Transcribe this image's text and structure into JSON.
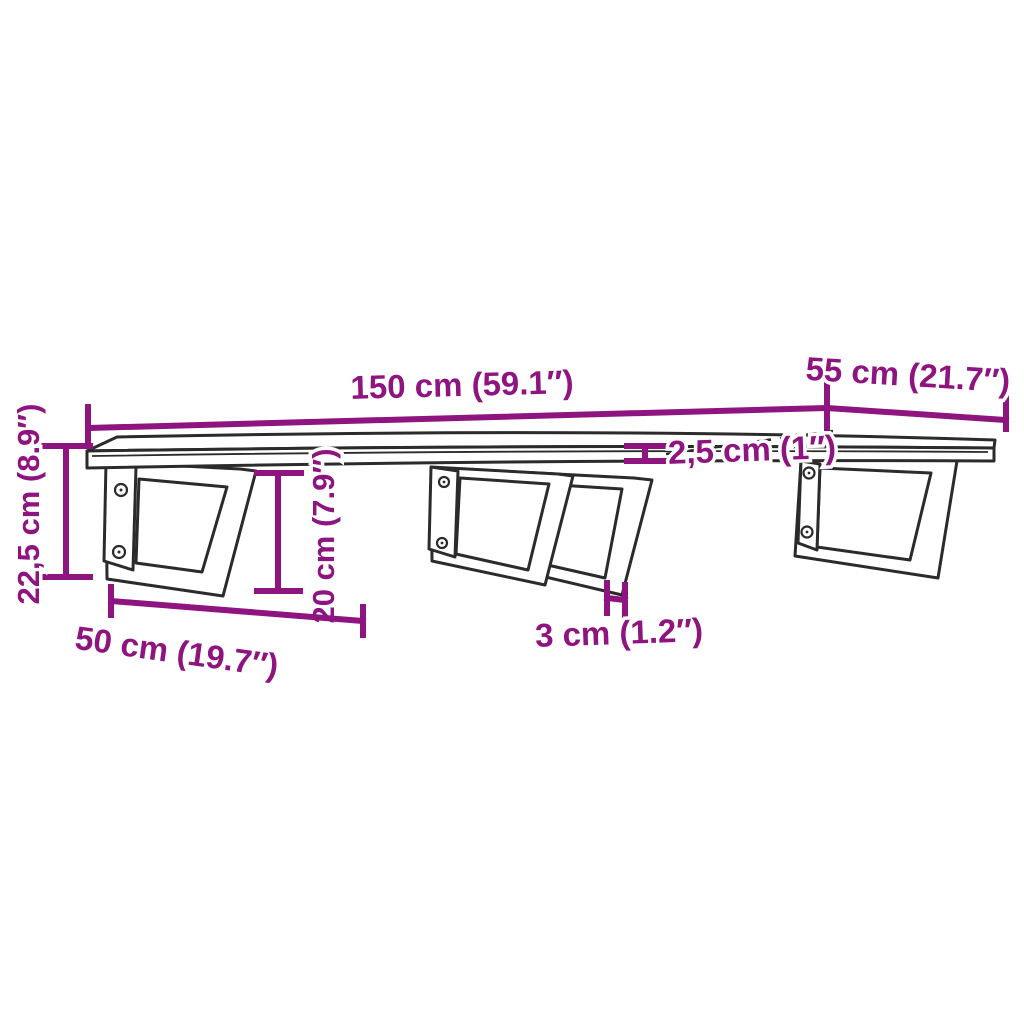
{
  "image": {
    "kind": "furniture dimension diagram",
    "subject": "wall-mounted shelf board on steel trapezoid brackets",
    "background": "#ffffff"
  },
  "colors": {
    "dimension_annotations": "#8E1480",
    "drawing_outline": "#2b2b2b"
  },
  "dimensions": {
    "board_length": "150 cm (59.1″)",
    "board_depth": "55 cm (21.7″)",
    "board_thickness": "2,5 cm (1″)",
    "total_height": "22,5 cm (8.9″)",
    "bracket_height": "20 cm (7.9″)",
    "bracket_depth": "50 cm (19.7″)",
    "bracket_thickness": "3 cm (1.2″)"
  }
}
